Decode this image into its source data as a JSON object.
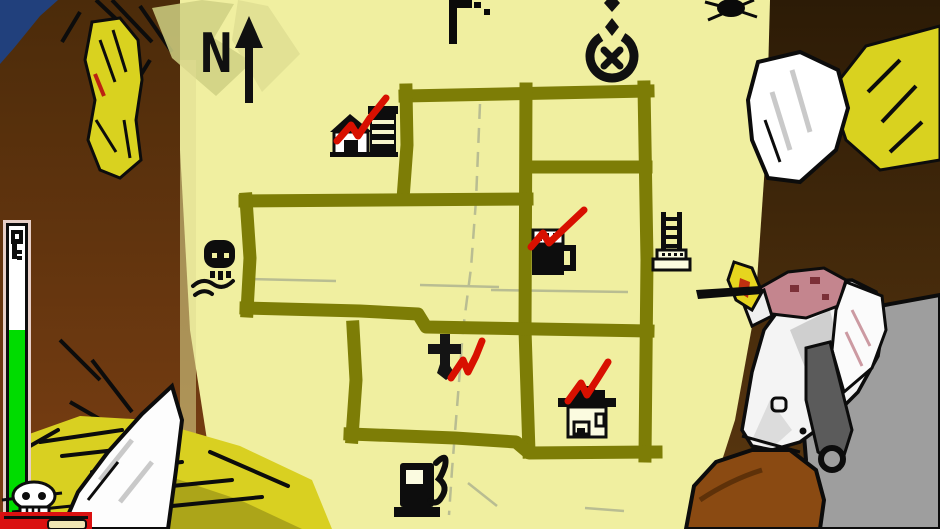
{
  "meta": {
    "description": "Pixel-art game screenshot: two characters hold a hand-drawn map on yellowed paper; several landmarks are marked, some ticked off with red checkmarks.",
    "view": "map-inspection-screen"
  },
  "compass": {
    "label": "N"
  },
  "colors": {
    "paper": "#f0efa0",
    "paper_shadow": "#cfd083",
    "road": "#7d7d06",
    "check": "#d81000",
    "ink": "#0d0d0d",
    "pencil": "#b9bd92",
    "sky_blue": "#21407c",
    "brown_dark": "#2c1b06",
    "brown_light": "#7c3f13",
    "hand_yellow": "#d9d21f",
    "hay_yellow": "#d9d021",
    "cloak_gray": "#9e9e9e",
    "wound_pink": "#c4858e",
    "coat_brown": "#8a4a12",
    "meter_green": "#00dc00",
    "meter_frame_pink": "#e7cfc7",
    "bar_red": "#da1010"
  },
  "map": {
    "locations": [
      {
        "name": "barn-with-silo",
        "checked": true
      },
      {
        "name": "skull-crossbones",
        "checked": false
      },
      {
        "name": "beer-mug",
        "checked": true
      },
      {
        "name": "watchtower-ladder",
        "checked": false
      },
      {
        "name": "church-cross",
        "checked": true
      },
      {
        "name": "shrine-house",
        "checked": true
      },
      {
        "name": "gas-pump",
        "checked": false
      },
      {
        "name": "star-and-crescent",
        "checked": false
      }
    ],
    "checked_count": 4,
    "pencil_creases": true
  },
  "hud": {
    "meter": {
      "orientation": "vertical",
      "icon": "key",
      "fill_color": "#00dc00",
      "fill_percent": 64
    },
    "skull_marker": "skull",
    "bottom_bar_color": "#da1010"
  }
}
